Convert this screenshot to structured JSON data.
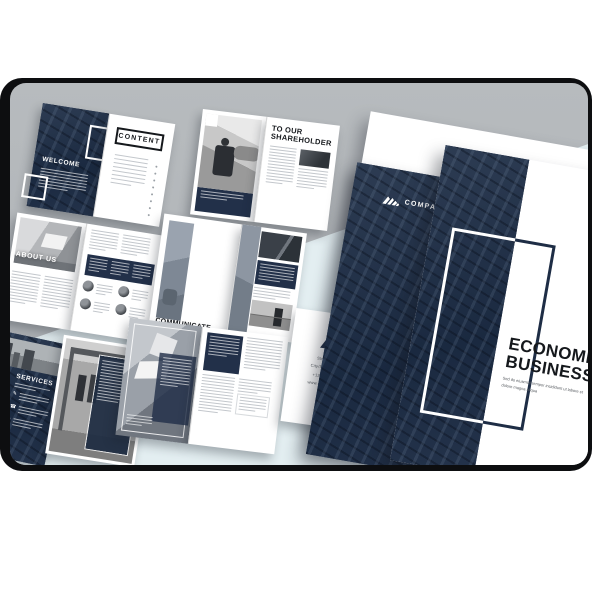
{
  "pages": {
    "welcome": {
      "title": "WELCOME"
    },
    "content": {
      "title": "CONTENT"
    },
    "shareholder": {
      "title_line1": "TO OUR",
      "title_line2": "SHAREHOLDER"
    },
    "about": {
      "title": "ABOUT US"
    },
    "communicate": {
      "title_line1": "COMMUNICATE",
      "title_line2": "& WORD"
    },
    "services": {
      "title": "SERVICES"
    },
    "back_cover": {
      "address_line1": "Street Name",
      "address_line2": "City/State - 12345",
      "address_line3": "+12 3456 7890",
      "address_line4": "www.company.com"
    },
    "company_cover": {
      "company_name": "COMPANY NAME"
    },
    "front_cover": {
      "title_line1": "ECONOMIC",
      "title_line2": "BUSINESS",
      "subtitle": "Sed do eiusmod tempor incididunt ut labore et dolore magna aliqua"
    }
  },
  "icons": {
    "services_bullet_1": "edit-icon",
    "services_bullet_2": "phone-icon",
    "services_bullet_3": "heart-icon",
    "logo": "company-logo-icon"
  },
  "colors": {
    "navy": "#223049",
    "background_gray": "#b4b8bb",
    "background_blue": "#e3eef1",
    "page_white": "#ffffff",
    "frame_black": "#0d0e10"
  }
}
